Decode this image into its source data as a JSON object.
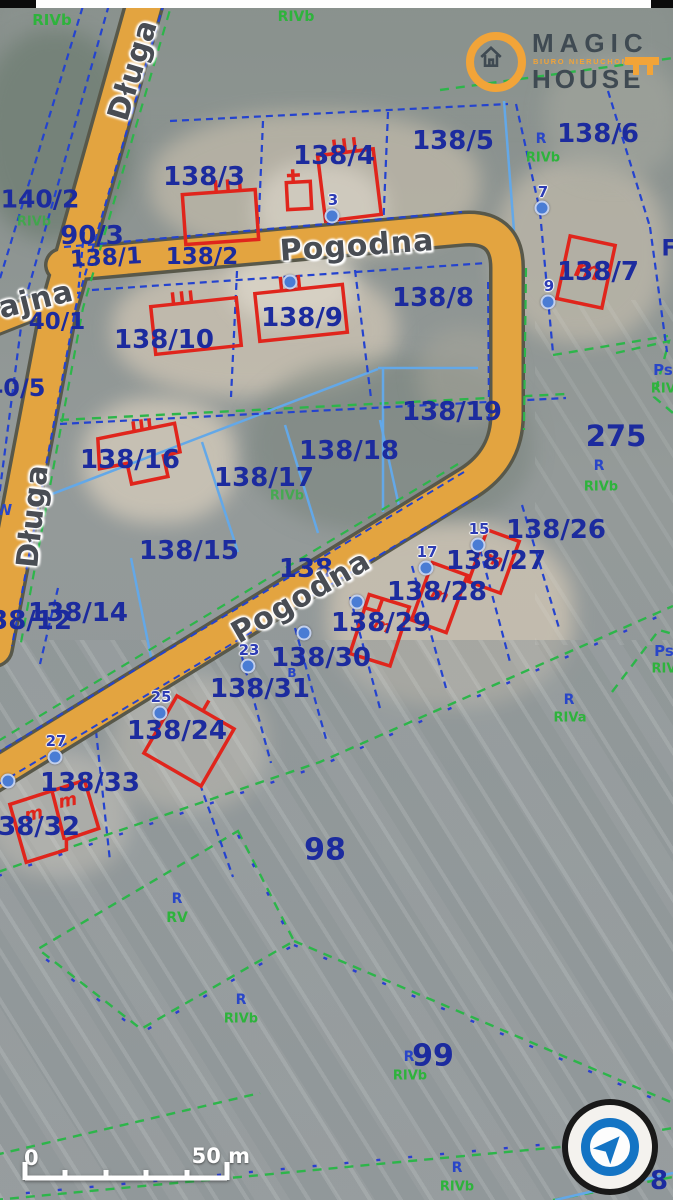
{
  "logo": {
    "title_top": "MAGIC",
    "title_bottom": "HOUSE",
    "tagline": "BIURO NIERUCHOMOŚCI",
    "brand_orange": "#f2a438",
    "brand_dark": "#3f4a52"
  },
  "scale_bar": {
    "start": "0",
    "end": "50 m"
  },
  "compass": {
    "icon": "navigation-arrow",
    "color": "#1474c4"
  },
  "colors": {
    "road_orange": "#e3a440",
    "parcel_line_blue": "#2443cf",
    "landuse_green": "#2db54a",
    "utility_cyan": "#63a8e8",
    "building_red": "#e0251c",
    "parcel_text_blue": "#1c2b9e"
  },
  "map": {
    "street_labels": [
      {
        "text": "Długa",
        "x": 133,
        "y": 70,
        "rot": -73,
        "size": 30
      },
      {
        "text": "Pogodna",
        "x": 357,
        "y": 246,
        "rot": -4,
        "size": 30
      },
      {
        "text": "ajna",
        "x": 36,
        "y": 300,
        "rot": -14,
        "size": 30
      },
      {
        "text": "Długa",
        "x": 33,
        "y": 516,
        "rot": -84,
        "size": 30
      },
      {
        "text": "Pogodna",
        "x": 301,
        "y": 597,
        "rot": -30,
        "size": 30
      }
    ],
    "parcel_labels": [
      {
        "text": "140/2",
        "x": 40,
        "y": 199,
        "size": 25
      },
      {
        "text": "90/3",
        "x": 92,
        "y": 236,
        "size": 26
      },
      {
        "text": "138/1",
        "x": 106,
        "y": 258,
        "size": 23,
        "rot": -3
      },
      {
        "text": "138/2",
        "x": 202,
        "y": 257,
        "size": 23
      },
      {
        "text": "138/3",
        "x": 204,
        "y": 177,
        "size": 26
      },
      {
        "text": "138/4",
        "x": 334,
        "y": 156,
        "size": 26
      },
      {
        "text": "138/5",
        "x": 453,
        "y": 141,
        "size": 26
      },
      {
        "text": "138/6",
        "x": 598,
        "y": 134,
        "size": 26
      },
      {
        "text": "138/7",
        "x": 598,
        "y": 272,
        "size": 26
      },
      {
        "text": "138/8",
        "x": 433,
        "y": 298,
        "size": 26
      },
      {
        "text": "138/9",
        "x": 302,
        "y": 318,
        "size": 26
      },
      {
        "text": "138/10",
        "x": 164,
        "y": 340,
        "size": 26
      },
      {
        "text": "40/1",
        "x": 57,
        "y": 322,
        "size": 23
      },
      {
        "text": "40/5",
        "x": 16,
        "y": 388,
        "size": 24
      },
      {
        "text": "138/19",
        "x": 452,
        "y": 412,
        "size": 26
      },
      {
        "text": "275",
        "x": 616,
        "y": 436,
        "size": 29
      },
      {
        "text": "138/18",
        "x": 349,
        "y": 451,
        "size": 26
      },
      {
        "text": "138/17",
        "x": 264,
        "y": 478,
        "size": 26
      },
      {
        "text": "138/16",
        "x": 130,
        "y": 460,
        "size": 26
      },
      {
        "text": "138/15",
        "x": 189,
        "y": 551,
        "size": 26
      },
      {
        "text": "138",
        "x": 306,
        "y": 569,
        "size": 26
      },
      {
        "text": "138/14",
        "x": 78,
        "y": 613,
        "size": 26
      },
      {
        "text": "138/12",
        "x": 22,
        "y": 621,
        "size": 26
      },
      {
        "text": "138/26",
        "x": 556,
        "y": 530,
        "size": 26
      },
      {
        "text": "138/27",
        "x": 496,
        "y": 561,
        "size": 26
      },
      {
        "text": "138/28",
        "x": 437,
        "y": 592,
        "size": 26
      },
      {
        "text": "138/29",
        "x": 381,
        "y": 623,
        "size": 26
      },
      {
        "text": "138/30",
        "x": 321,
        "y": 658,
        "size": 26
      },
      {
        "text": "138/31",
        "x": 260,
        "y": 689,
        "size": 26
      },
      {
        "text": "138/24",
        "x": 177,
        "y": 731,
        "size": 26
      },
      {
        "text": "138/33",
        "x": 90,
        "y": 783,
        "size": 26
      },
      {
        "text": "138/32",
        "x": 30,
        "y": 827,
        "size": 26
      },
      {
        "text": "98",
        "x": 325,
        "y": 850,
        "size": 30
      },
      {
        "text": "99",
        "x": 433,
        "y": 1056,
        "size": 30
      },
      {
        "text": "8",
        "x": 659,
        "y": 1181,
        "size": 26
      },
      {
        "text": "F",
        "x": 669,
        "y": 249,
        "size": 22
      }
    ],
    "landuse_labels": [
      {
        "text": "RIVb",
        "x": 52,
        "y": 20,
        "color": "green",
        "size": 15
      },
      {
        "text": "RIVb",
        "x": 296,
        "y": 17,
        "color": "green",
        "size": 14
      },
      {
        "text": "RIVb",
        "x": 34,
        "y": 222,
        "color": "green",
        "size": 13,
        "dim": true
      },
      {
        "text": "R",
        "x": 541,
        "y": 139,
        "color": "blue",
        "size": 14
      },
      {
        "text": "RIVb",
        "x": 543,
        "y": 158,
        "color": "green",
        "size": 13
      },
      {
        "text": "Ps",
        "x": 663,
        "y": 370,
        "color": "blue",
        "size": 15
      },
      {
        "text": "RIVb",
        "x": 668,
        "y": 389,
        "color": "green",
        "size": 13
      },
      {
        "text": "R",
        "x": 599,
        "y": 466,
        "color": "blue",
        "size": 14
      },
      {
        "text": "RIVb",
        "x": 601,
        "y": 487,
        "color": "green",
        "size": 13
      },
      {
        "text": "RIVb",
        "x": 287,
        "y": 496,
        "color": "green",
        "size": 13,
        "dim": true
      },
      {
        "text": "R",
        "x": 569,
        "y": 700,
        "color": "blue",
        "size": 14
      },
      {
        "text": "RIVa",
        "x": 570,
        "y": 718,
        "color": "green",
        "size": 13
      },
      {
        "text": "Ps",
        "x": 664,
        "y": 651,
        "color": "blue",
        "size": 15
      },
      {
        "text": "RIVa",
        "x": 668,
        "y": 669,
        "color": "green",
        "size": 13
      },
      {
        "text": "B",
        "x": 292,
        "y": 673,
        "color": "blue",
        "size": 12
      },
      {
        "text": "W",
        "x": 4,
        "y": 510,
        "color": "blue",
        "size": 15
      },
      {
        "text": "R",
        "x": 177,
        "y": 899,
        "color": "blue",
        "size": 14
      },
      {
        "text": "RV",
        "x": 177,
        "y": 918,
        "color": "green",
        "size": 14
      },
      {
        "text": "R",
        "x": 241,
        "y": 1000,
        "color": "blue",
        "size": 14
      },
      {
        "text": "RIVb",
        "x": 241,
        "y": 1019,
        "color": "green",
        "size": 13
      },
      {
        "text": "R",
        "x": 409,
        "y": 1057,
        "color": "blue",
        "size": 14
      },
      {
        "text": "RIVb",
        "x": 410,
        "y": 1076,
        "color": "green",
        "size": 13
      },
      {
        "text": "R",
        "x": 457,
        "y": 1168,
        "color": "blue",
        "size": 14
      },
      {
        "text": "RIVb",
        "x": 457,
        "y": 1187,
        "color": "green",
        "size": 13
      }
    ],
    "survey_points": [
      {
        "label": "3",
        "x": 332,
        "y": 216
      },
      {
        "label": "7",
        "x": 542,
        "y": 208
      },
      {
        "label": "9",
        "x": 548,
        "y": 302
      },
      {
        "label": "15",
        "x": 478,
        "y": 545
      },
      {
        "label": "17",
        "x": 426,
        "y": 568
      },
      {
        "label": "23",
        "x": 248,
        "y": 666
      },
      {
        "label": "25",
        "x": 160,
        "y": 713
      },
      {
        "label": "27",
        "x": 55,
        "y": 757
      },
      {
        "label": "",
        "x": 290,
        "y": 282
      },
      {
        "label": "",
        "x": 357,
        "y": 602
      },
      {
        "label": "",
        "x": 304,
        "y": 633
      },
      {
        "label": "",
        "x": 8,
        "y": 781
      }
    ]
  }
}
